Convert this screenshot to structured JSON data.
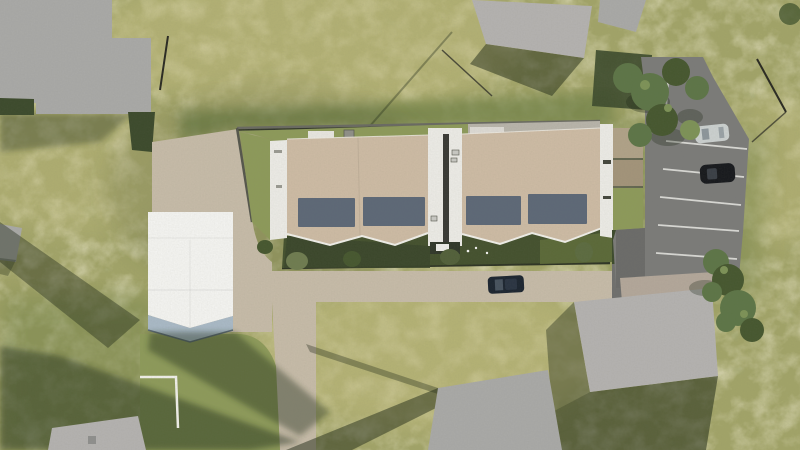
{
  "scene": {
    "title": "Aerial architectural site render",
    "description": "Top-down 3D architectural rendering: two tan-roofed terraced housing blocks with four rooftop solar panels around a narrow central courtyard, a white flat-roofed house on a paved plaza, private gardens with bushes, a rear paved lane with one dark car, a car park with a silver and a black parked car, lawns, trees and six neighbouring grey rooftops casting long shadows.",
    "palette": {
      "grass_base": "#a2a468",
      "grass_light": "#c0bb7e",
      "grass_mid": "#8d9a5a",
      "grass_dark": "#74844a",
      "shadow_dark": "#1f2916",
      "roof_gray": "#a9a9a7",
      "roof_gray_light": "#b4b2b0",
      "roof_beige": "#b3a79a",
      "roof_tan": "#cdbba4",
      "solar_panel": "#5d6877",
      "roof_white": "#f4f4f1",
      "facade_blue": "#a9b9c6",
      "paver": "#c6bba8",
      "concrete": "#b8b4aa",
      "walkway_white": "#ecebe6",
      "asphalt": "#7b7b79",
      "stripe_white": "#d9d9d5",
      "wall_dark": "#33382b",
      "hedge_dark": "#3c4a2c",
      "garden_shadow": "#44512e",
      "carport_wood": "#b0a288",
      "tree_green": "#5d7547",
      "tree_dark": "#46572f",
      "tree_light": "#7d9257",
      "car_silver": "#cbd0cf",
      "car_black": "#17191d",
      "car_navy": "#1c2530",
      "stair_dark": "#3a3a35"
    },
    "objects": {
      "rowhouse_blocks": 2,
      "solar_panels": 4,
      "white_houses": 1,
      "cars_in_car_park": 2,
      "cars_on_lane": 1,
      "neighbor_roofs": 6
    }
  }
}
